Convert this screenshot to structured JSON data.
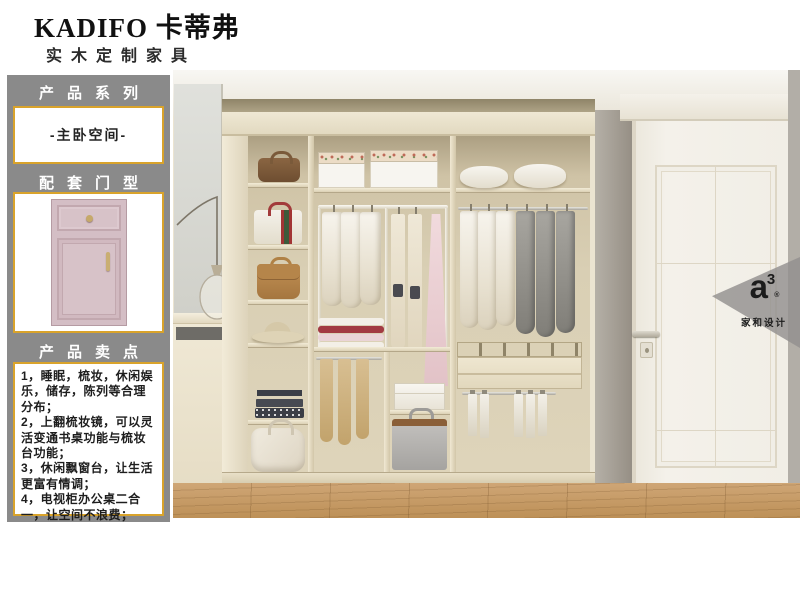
{
  "brand": {
    "name": "KADIFO 卡蒂弗",
    "subtitle": "实木定制家具"
  },
  "sidebar": {
    "series_title": "产品系列",
    "series_value": "-主卧空间-",
    "door_title": "配套门型",
    "selling_title": "产品卖点",
    "selling_points": [
      "1，睡眠，梳妆，休闲娱乐，储存，陈列等合理分布；",
      "2，上翻梳妆镜，可以灵活变通书桌功能与梳妆台功能；",
      "3，休闲飘窗台，让生活更富有情调；",
      "4，电视柜办公桌二合一，让空间不浪费；"
    ]
  },
  "watermark": {
    "logo_main": "a",
    "logo_sup": "3",
    "logo_reg": "®",
    "caption": "家和设计"
  },
  "colors": {
    "sidebar_bg": "#8a8a8a",
    "accent_gold": "#d9a32b",
    "door_pink": "#d4bec5",
    "wood_floor": "#c79e6b"
  }
}
